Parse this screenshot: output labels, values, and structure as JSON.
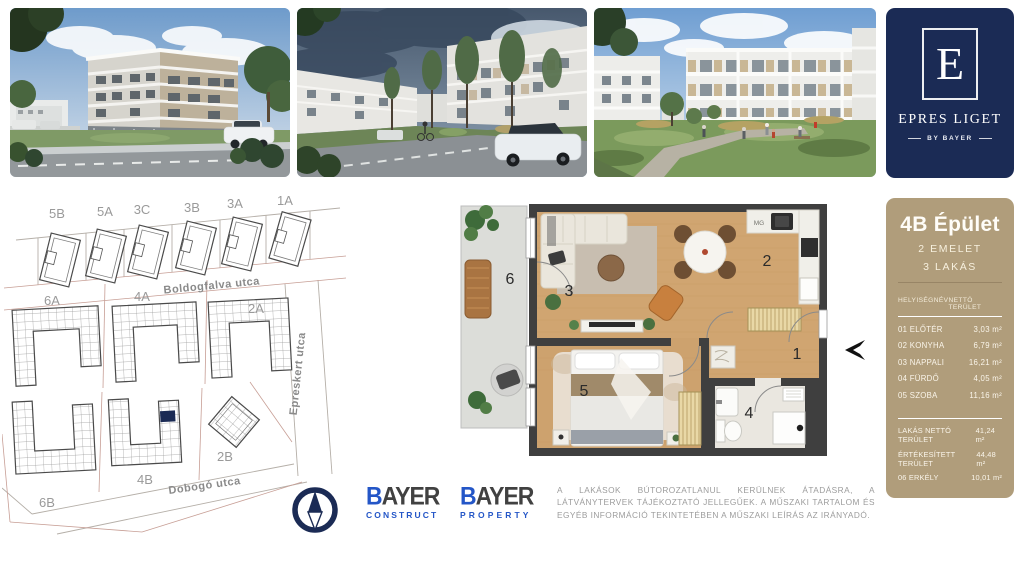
{
  "logo_card": {
    "letter": "E",
    "title": "EPRES LIGET",
    "byline": "BY BAYER"
  },
  "info_panel": {
    "title": "4B Épület",
    "subtitle1": "2 EMELET",
    "subtitle2": "3 LAKÁS",
    "table": {
      "col_name": "HELYISÉGNÉV",
      "col_area": "NETTÓ TERÜLET",
      "rows": [
        {
          "name": "01 ELŐTÉR",
          "area": "3,03 m²"
        },
        {
          "name": "02 KONYHA",
          "area": "6,79 m²"
        },
        {
          "name": "03 NAPPALI",
          "area": "16,21 m²"
        },
        {
          "name": "04 FÜRDŐ",
          "area": "4,05 m²"
        },
        {
          "name": "05 SZOBA",
          "area": "11,16 m²"
        }
      ]
    },
    "summary": [
      {
        "name": "LAKÁS NETTÓ TERÜLET",
        "area": "41,24 m²"
      },
      {
        "name": "ÉRTÉKESÍTETT TERÜLET",
        "area": "44,48 m²"
      },
      {
        "name": "06 ERKÉLY",
        "area": "10,01 m²"
      }
    ]
  },
  "site_plan": {
    "plots_top": [
      "5B",
      "5A",
      "3C",
      "3B",
      "3A",
      "1A"
    ],
    "plots_mid": [
      "6A",
      "4A",
      "2A"
    ],
    "plots_bottom": [
      "6B",
      "4B",
      "2B"
    ],
    "street_top": "Boldogfalva utca",
    "street_right": "Epreskert utca",
    "street_bottom": "Dobogó utca"
  },
  "floor_plan": {
    "rooms": {
      "hall": "1",
      "kitchen": "2",
      "living": "3",
      "bath": "4",
      "bedroom": "5",
      "balcony": "6"
    },
    "appliance_label": "MG"
  },
  "brands": {
    "construct": {
      "initial": "B",
      "rest": "AYER",
      "sub": "CONSTRUCT"
    },
    "property": {
      "initial": "B",
      "rest": "AYER",
      "sub": "PROPERTY"
    }
  },
  "disclaimer": "A LAKÁSOK BÚTOROZATLANUL KERÜLNEK ÁTADÁSRA, A LÁTVÁNYTERVEK TÁJÉKOZTATÓ JELLEGŰEK. A MŰSZAKI TARTALOM ÉS EGYÉB INFORMÁCIÓ TEKINTETÉBEN A MŰSZAKI LEÍRÁS AZ IRÁNYADÓ.",
  "colors": {
    "navy": "#1b2b55",
    "tan": "#b09d7b",
    "brand_blue": "#2456c7"
  }
}
